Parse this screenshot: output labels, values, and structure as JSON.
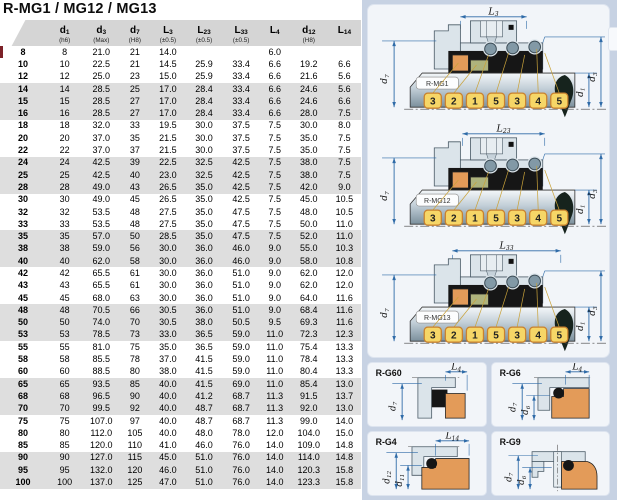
{
  "title": "R-MG1 / MG12 / MG13",
  "table": {
    "columns": [
      {
        "m": "",
        "s": "",
        "tol": ""
      },
      {
        "m": "d",
        "s": "1",
        "tol": "(h6)"
      },
      {
        "m": "d",
        "s": "3",
        "tol": "(Max)"
      },
      {
        "m": "d",
        "s": "7",
        "tol": "(H8)"
      },
      {
        "m": "L",
        "s": "3",
        "tol": "(±0.5)"
      },
      {
        "m": "L",
        "s": "23",
        "tol": "(±0.5)"
      },
      {
        "m": "L",
        "s": "33",
        "tol": "(±0.5)"
      },
      {
        "m": "L",
        "s": "4",
        "tol": ""
      },
      {
        "m": "d",
        "s": "12",
        "tol": "(H8)"
      },
      {
        "m": "L",
        "s": "14",
        "tol": ""
      }
    ],
    "rows": [
      [
        "8",
        "8",
        "21.0",
        "21",
        "14.0",
        "",
        "",
        "6.0",
        "",
        ""
      ],
      [
        "10",
        "10",
        "22.5",
        "21",
        "14.5",
        "25.9",
        "33.4",
        "6.6",
        "19.2",
        "6.6"
      ],
      [
        "12",
        "12",
        "25.0",
        "23",
        "15.0",
        "25.9",
        "33.4",
        "6.6",
        "21.6",
        "5.6"
      ],
      [
        "14",
        "14",
        "28.5",
        "25",
        "17.0",
        "28.4",
        "33.4",
        "6.6",
        "24.6",
        "5.6"
      ],
      [
        "15",
        "15",
        "28.5",
        "27",
        "17.0",
        "28.4",
        "33.4",
        "6.6",
        "24.6",
        "6.6"
      ],
      [
        "16",
        "16",
        "28.5",
        "27",
        "17.0",
        "28.4",
        "33.4",
        "6.6",
        "28.0",
        "7.5"
      ],
      [
        "18",
        "18",
        "32.0",
        "33",
        "19.5",
        "30.0",
        "37.5",
        "7.5",
        "30.0",
        "8.0"
      ],
      [
        "20",
        "20",
        "37.0",
        "35",
        "21.5",
        "30.0",
        "37.5",
        "7.5",
        "35.0",
        "7.5"
      ],
      [
        "22",
        "22",
        "37.0",
        "37",
        "21.5",
        "30.0",
        "37.5",
        "7.5",
        "35.0",
        "7.5"
      ],
      [
        "24",
        "24",
        "42.5",
        "39",
        "22.5",
        "32.5",
        "42.5",
        "7.5",
        "38.0",
        "7.5"
      ],
      [
        "25",
        "25",
        "42.5",
        "40",
        "23.0",
        "32.5",
        "42.5",
        "7.5",
        "38.0",
        "7.5"
      ],
      [
        "28",
        "28",
        "49.0",
        "43",
        "26.5",
        "35.0",
        "42.5",
        "7.5",
        "42.0",
        "9.0"
      ],
      [
        "30",
        "30",
        "49.0",
        "45",
        "26.5",
        "35.0",
        "42.5",
        "7.5",
        "45.0",
        "10.5"
      ],
      [
        "32",
        "32",
        "53.5",
        "48",
        "27.5",
        "35.0",
        "47.5",
        "7.5",
        "48.0",
        "10.5"
      ],
      [
        "33",
        "33",
        "53.5",
        "48",
        "27.5",
        "35.0",
        "47.5",
        "7.5",
        "50.0",
        "11.0"
      ],
      [
        "35",
        "35",
        "57.0",
        "50",
        "28.5",
        "35.0",
        "47.5",
        "7.5",
        "52.0",
        "11.0"
      ],
      [
        "38",
        "38",
        "59.0",
        "56",
        "30.0",
        "36.0",
        "46.0",
        "9.0",
        "55.0",
        "10.3"
      ],
      [
        "40",
        "40",
        "62.0",
        "58",
        "30.0",
        "36.0",
        "46.0",
        "9.0",
        "58.0",
        "10.8"
      ],
      [
        "42",
        "42",
        "65.5",
        "61",
        "30.0",
        "36.0",
        "51.0",
        "9.0",
        "62.0",
        "12.0"
      ],
      [
        "43",
        "43",
        "65.5",
        "61",
        "30.0",
        "36.0",
        "51.0",
        "9.0",
        "62.0",
        "12.0"
      ],
      [
        "45",
        "45",
        "68.0",
        "63",
        "30.0",
        "36.0",
        "51.0",
        "9.0",
        "64.0",
        "11.6"
      ],
      [
        "48",
        "48",
        "70.5",
        "66",
        "30.5",
        "36.0",
        "51.0",
        "9.0",
        "68.4",
        "11.6"
      ],
      [
        "50",
        "50",
        "74.0",
        "70",
        "30.5",
        "38.0",
        "50.5",
        "9.5",
        "69.3",
        "11.6"
      ],
      [
        "53",
        "53",
        "78.5",
        "73",
        "33.0",
        "36.5",
        "59.0",
        "11.0",
        "72.3",
        "12.3"
      ],
      [
        "55",
        "55",
        "81.0",
        "75",
        "35.0",
        "36.5",
        "59.0",
        "11.0",
        "75.4",
        "13.3"
      ],
      [
        "58",
        "58",
        "85.5",
        "78",
        "37.0",
        "41.5",
        "59.0",
        "11.0",
        "78.4",
        "13.3"
      ],
      [
        "60",
        "60",
        "88.5",
        "80",
        "38.0",
        "41.5",
        "59.0",
        "11.0",
        "80.4",
        "13.3"
      ],
      [
        "65",
        "65",
        "93.5",
        "85",
        "40.0",
        "41.5",
        "69.0",
        "11.0",
        "85.4",
        "13.0"
      ],
      [
        "68",
        "68",
        "96.5",
        "90",
        "40.0",
        "41.2",
        "68.7",
        "11.3",
        "91.5",
        "13.7"
      ],
      [
        "70",
        "70",
        "99.5",
        "92",
        "40.0",
        "48.7",
        "68.7",
        "11.3",
        "92.0",
        "13.0"
      ],
      [
        "75",
        "75",
        "107.0",
        "97",
        "40.0",
        "48.7",
        "68.7",
        "11.3",
        "99.0",
        "14.0"
      ],
      [
        "80",
        "80",
        "112.0",
        "105",
        "40.0",
        "48.0",
        "78.0",
        "12.0",
        "104.0",
        "15.0"
      ],
      [
        "85",
        "85",
        "120.0",
        "110",
        "41.0",
        "46.0",
        "76.0",
        "14.0",
        "109.0",
        "14.8"
      ],
      [
        "90",
        "90",
        "127.0",
        "115",
        "45.0",
        "51.0",
        "76.0",
        "14.0",
        "114.0",
        "14.8"
      ],
      [
        "95",
        "95",
        "132.0",
        "120",
        "46.0",
        "51.0",
        "76.0",
        "14.0",
        "120.3",
        "15.8"
      ],
      [
        "100",
        "100",
        "137.0",
        "125",
        "47.0",
        "51.0",
        "76.0",
        "14.0",
        "123.3",
        "15.8"
      ]
    ]
  },
  "main_diagrams": [
    {
      "id": "R-MG1",
      "dim": {
        "m": "L",
        "s": "3"
      },
      "left_dim": {
        "m": "d",
        "s": "7"
      },
      "right_dims": [
        {
          "m": "d",
          "s": "1"
        },
        {
          "m": "d",
          "s": "3"
        }
      ],
      "callouts": [
        "3",
        "2",
        "1",
        "5",
        "3",
        "4",
        "5"
      ]
    },
    {
      "id": "R-MG12",
      "dim": {
        "m": "L",
        "s": "23"
      },
      "left_dim": {
        "m": "d",
        "s": "7"
      },
      "right_dims": [
        {
          "m": "d",
          "s": "1"
        },
        {
          "m": "d",
          "s": "3"
        }
      ],
      "callouts": [
        "3",
        "2",
        "1",
        "5",
        "3",
        "4",
        "5"
      ]
    },
    {
      "id": "R-MG13",
      "dim": {
        "m": "L",
        "s": "33"
      },
      "left_dim": {
        "m": "d",
        "s": "7"
      },
      "right_dims": [
        {
          "m": "d",
          "s": "1"
        },
        {
          "m": "d",
          "s": "3"
        }
      ],
      "callouts": [
        "3",
        "2",
        "1",
        "5",
        "3",
        "4",
        "5"
      ]
    }
  ],
  "seat_diagrams": [
    {
      "id": "R-G60",
      "dim": {
        "m": "L",
        "s": "4"
      },
      "left_dims": [
        {
          "m": "d",
          "s": "7"
        }
      ]
    },
    {
      "id": "R-G6",
      "dim": {
        "m": "L",
        "s": "4"
      },
      "left_dims": [
        {
          "m": "d",
          "s": "7"
        },
        {
          "m": "d",
          "s": "6"
        }
      ]
    },
    {
      "id": "R-G4",
      "dim": {
        "m": "L",
        "s": "14"
      },
      "left_dims": [
        {
          "m": "d",
          "s": "12"
        },
        {
          "m": "d",
          "s": "11"
        }
      ]
    },
    {
      "id": "R-G9",
      "dim": null,
      "left_dims": [
        {
          "m": "d",
          "s": "7"
        },
        {
          "m": "d",
          "s": "6"
        }
      ]
    }
  ],
  "colors": {
    "dim_blue": "#2f6ba8",
    "metal": "#dbe4ea",
    "metal_stroke": "#4a5a66",
    "elastomer": "#161616",
    "seat_orange": "#e39b59",
    "collar_green": "#aeb37d",
    "spring_gray": "#8299a6",
    "callout_fill": "#f6d667",
    "callout_border": "#c9822e",
    "leader": "#c9a23a",
    "teardrop": "#16231d",
    "row_shade": "#dedede",
    "header_gray": "#d5d5d5",
    "panel_bg": "#c7d2e3",
    "red_edge": "#7c2128"
  }
}
